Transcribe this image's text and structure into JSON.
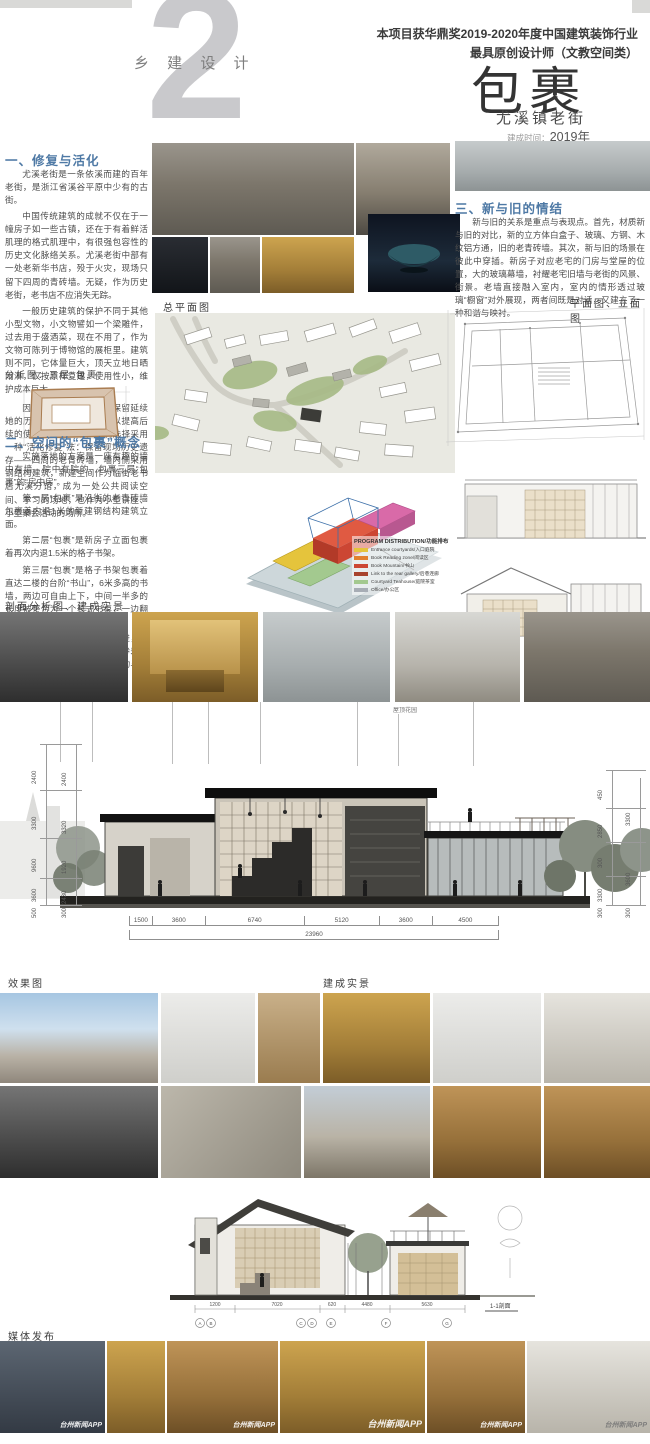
{
  "header": {
    "category": "乡 建 设 计",
    "big_number": "2",
    "award_line1": "本项目获华鼎奖2019-2020年度中国建筑装饰行业",
    "award_line2": "最具原创设计师（文教空间类）",
    "title": "包裹",
    "subtitle": "尤溪镇老街",
    "time_label": "建成时间：",
    "time_value": "2019年"
  },
  "section1": {
    "title": "一、修复与活化",
    "paras": [
      "尤溪老街是一条依溪而建的百年老街，是浙江省溪谷平原中少有的古街。",
      "中国传统建筑的成就不仅在于一幢房子如一些古镇，还在于有着鲜活肌理的格式肌理中，有很强包容性的历史文化脉络关系。尤溪老街中部有一处老新华书店，殁于火灾，现场只留下四周的青砖墙。无疑，作为历史老街，老书店不应消失无踪。",
      "一般历史建筑的保护不同于其他小型文物，小文物譬如一个梁雕件，过去用于盛酒菜，现在不用了，作为文物可陈列于博物馆的展柜里。建筑则不同，它体量巨大，顶天立地日晒雨淋，仅按原样复建，使用性小，维护成本巨大。",
      "因此，传统建筑既需要保留延续她的历史状况，又需要改造以提高后续的使用效率。此案，我们选择采用一种“活化修复”法：保留现场历史遗存——四周的老青砖墙，墙内侧采用钢结构建筑，新建空间作为临街老书店尤溪分馆，成为一处公共阅读空间、学习的场地，也作为小型讲座、小型聚会活动的场所。"
    ]
  },
  "analysis": {
    "label": "分析图：三层“包裹”"
  },
  "section2": {
    "title": "二、空间的“包裹”概念",
    "paras": [
      "实施落地的方案是一座有趣的墙中有墙、院中有院的、包裹三层“包裹”的“房中房”。",
      "第一层“包裹”是沿街的老青砖墙包裹着内退1米的新建钢结构建筑立面。",
      "第二层“包裹”是新房子立面包裹着再次内退1.5米的格子书架。",
      "第三层“包裹”是格子书架包裹着直达二楼的台阶“书山”，6米多高的书墙，两边可自由上下，中间一半多的长度被整合为一个长式书桌，一边翻书，一边可供读者坐着看书。",
      "三层包裹带出了交叠与递进，形成了空间的节奏与张弛，轻重参差错落变化韵味，营造了场所的流动与静谧、现实与朦胧、直白与含蓄。"
    ]
  },
  "section3": {
    "title": "三、新与旧的情结",
    "para": "新与旧的关系是重点与表现点。首先，材质新与旧的对比，新的立方体白盒子、玻璃、方钢、木纹铝方通，旧的老青砖墙。其次，新与旧的场景在彼此中穿插。新房子对应老宅的门房与堂屋的位置，大的玻璃幕墙，衬耀老宅旧墙与老街的风景、街景。老墙直接融入室内，室内的情形透过玻璃“橱窗”对外展现，两者间既是对话，又建立了一种和谐与映衬。"
  },
  "labels": {
    "site_plan": "总平面图",
    "plan_elev": "平面图、立面图",
    "section_photos": "剖面分析图、建成实景",
    "render": "效果图",
    "built": "建成实景",
    "media": "媒体发布",
    "roof_garden": "屋顶花园"
  },
  "program_legend": {
    "title": "PROGRAM DISTRIBUTION/功能排布",
    "items": [
      {
        "color": "#e5c43c",
        "label": "Entrance courtyards/入口庭院"
      },
      {
        "color": "#e2802f",
        "label": "Book Reading zone/阅读区"
      },
      {
        "color": "#cc4633",
        "label": "Book Mountain/书山"
      },
      {
        "color": "#a8432e",
        "label": "Link to the rear gallery/后巷连廊"
      },
      {
        "color": "#a3c98f",
        "label": "Courtyard Teahouse/庭院茶室"
      },
      {
        "color": "#a7adb5",
        "label": "Office/办公区"
      }
    ]
  },
  "section_dims": {
    "bottom": [
      "1500",
      "3600",
      "6740",
      "5120",
      "3600",
      "4500"
    ],
    "bottom_total": "23960",
    "left_outer": [
      "2400",
      "3300",
      "9600",
      "3600",
      "500"
    ],
    "left_inner": [
      "2400",
      "3320",
      "1920",
      "2430",
      "300"
    ],
    "right_inner": [
      "450",
      "2850",
      "300",
      "3300",
      "300"
    ],
    "right_outer": [
      "3300",
      "3600",
      "300"
    ]
  },
  "small_section": {
    "dims": [
      "1200",
      "7020",
      "620",
      "4480",
      "5630"
    ],
    "bubbles": [
      "A",
      "B",
      "C",
      "D",
      "E",
      "F",
      "G"
    ],
    "label": "1-1剖面"
  },
  "watermark": "台州新闻APP"
}
